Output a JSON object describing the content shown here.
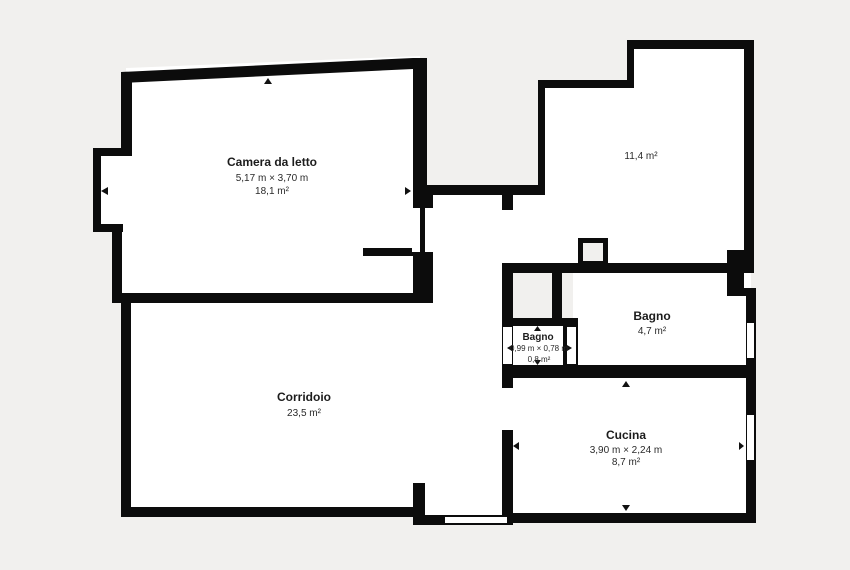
{
  "plan": {
    "type": "apartment-floor-plan",
    "colors": {
      "background": "#f1f0ee",
      "walls": "#0c0c0c",
      "floor": "#ffffff",
      "text": "#1c1c1c",
      "shaft_fill": "#f1f0ee"
    }
  },
  "rooms": {
    "camera_da_letto": {
      "name": "Camera da letto",
      "dimensions": "5,17 m × 3,70 m",
      "area": "18,1 m²"
    },
    "locale_11": {
      "area": "11,4 m²"
    },
    "corridoio": {
      "name": "Corridoio",
      "area": "23,5 m²"
    },
    "bagno_piccolo": {
      "name": "Bagno",
      "dimensions": "0,99 m × 0,78 m",
      "area": "0,8 m²"
    },
    "bagno": {
      "name": "Bagno",
      "area": "4,7 m²"
    },
    "cucina": {
      "name": "Cucina",
      "dimensions": "3,90 m × 2,24 m",
      "area": "8,7 m²"
    }
  }
}
